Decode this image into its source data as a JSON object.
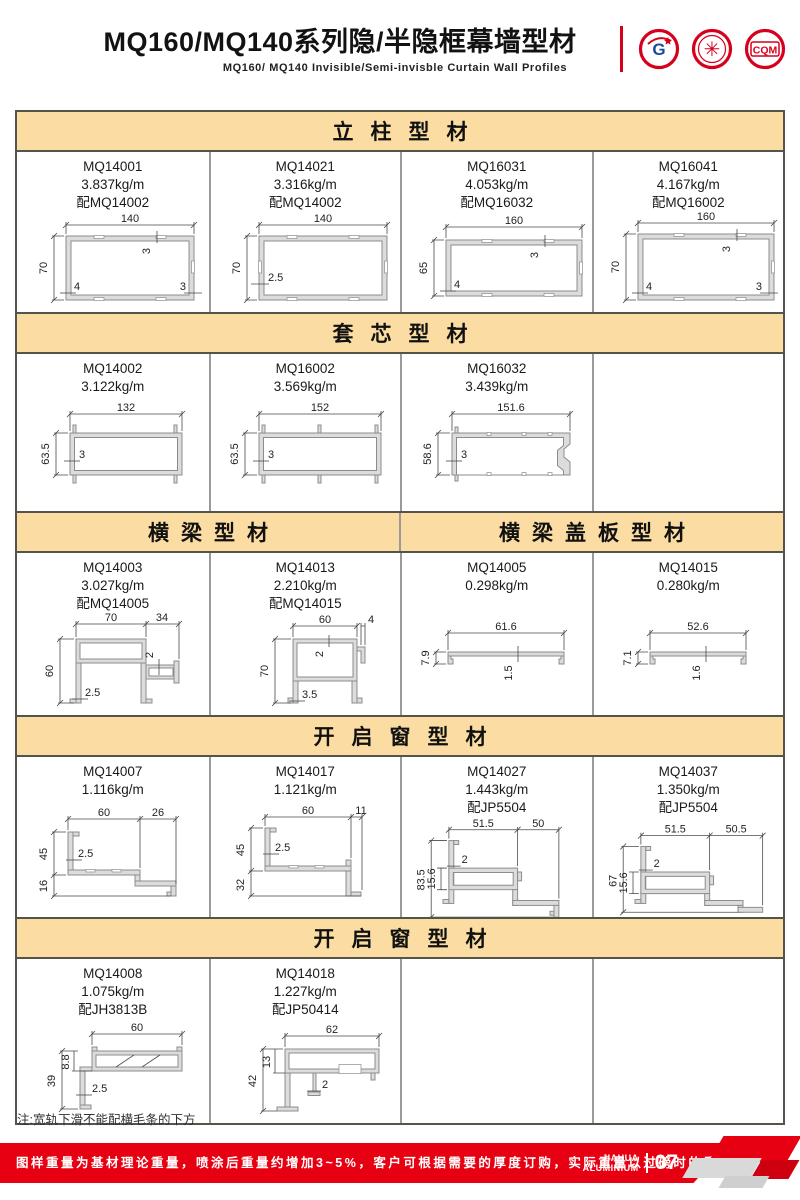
{
  "header": {
    "title": "MQ160/MQ140系列隐/半隐框幕墙型材",
    "subtitle": "MQ160/ MQ140  Invisible/Semi-invisble  Curtain  Wall  Profiles",
    "logo1_letter": "G",
    "logo2_glyph": "✳",
    "logo3_text": "CQM"
  },
  "sections": {
    "s1": "立柱型材",
    "s2": "套芯型材",
    "s3a": "横梁型材",
    "s3b": "横梁盖板型材",
    "s4": "开启窗型材",
    "s5": "开启窗型材"
  },
  "profiles": {
    "mq14001": {
      "code": "MQ14001",
      "weight": "3.837kg/m",
      "match": "配MQ14002",
      "d1": "140",
      "d2": "70",
      "d3": "3",
      "d4": "4",
      "d5": "3"
    },
    "mq14021": {
      "code": "MQ14021",
      "weight": "3.316kg/m",
      "match": "配MQ14002",
      "d1": "140",
      "d2": "70",
      "d3": "2.5"
    },
    "mq16031": {
      "code": "MQ16031",
      "weight": "4.053kg/m",
      "match": "配MQ16032",
      "d1": "160",
      "d2": "65",
      "d3": "3",
      "d4": "4"
    },
    "mq16041": {
      "code": "MQ16041",
      "weight": "4.167kg/m",
      "match": "配MQ16002",
      "d1": "160",
      "d2": "70",
      "d3": "3",
      "d4": "4",
      "d5": "3"
    },
    "mq14002": {
      "code": "MQ14002",
      "weight": "3.122kg/m",
      "d1": "132",
      "d2": "63.5",
      "d3": "3"
    },
    "mq16002": {
      "code": "MQ16002",
      "weight": "3.569kg/m",
      "d1": "152",
      "d2": "63.5",
      "d3": "3"
    },
    "mq16032": {
      "code": "MQ16032",
      "weight": "3.439kg/m",
      "d1": "151.6",
      "d2": "58.6",
      "d3": "3"
    },
    "mq14003": {
      "code": "MQ14003",
      "weight": "3.027kg/m",
      "match": "配MQ14005",
      "d1": "70",
      "d2": "34",
      "d3": "60",
      "d4": "2.5",
      "d5": "2"
    },
    "mq14013": {
      "code": "MQ14013",
      "weight": "2.210kg/m",
      "match": "配MQ14015",
      "d1": "60",
      "d2": "4",
      "d3": "70",
      "d4": "2",
      "d5": "3.5"
    },
    "mq14005": {
      "code": "MQ14005",
      "weight": "0.298kg/m",
      "d1": "61.6",
      "d2": "7.9",
      "d3": "1.5"
    },
    "mq14015": {
      "code": "MQ14015",
      "weight": "0.280kg/m",
      "d1": "52.6",
      "d2": "7.1",
      "d3": "1.6"
    },
    "mq14007": {
      "code": "MQ14007",
      "weight": "1.116kg/m",
      "d1": "60",
      "d2": "26",
      "d3": "45",
      "d4": "16",
      "d5": "2.5"
    },
    "mq14017": {
      "code": "MQ14017",
      "weight": "1.121kg/m",
      "d1": "60",
      "d2": "11",
      "d3": "45",
      "d4": "32",
      "d5": "2.5"
    },
    "mq14027": {
      "code": "MQ14027",
      "weight": "1.443kg/m",
      "match": "配JP5504",
      "d1": "51.5",
      "d2": "50",
      "d3": "83.5",
      "d4": "15.6",
      "d5": "2"
    },
    "mq14037": {
      "code": "MQ14037",
      "weight": "1.350kg/m",
      "match": "配JP5504",
      "d1": "51.5",
      "d2": "50.5",
      "d3": "67",
      "d4": "15.6",
      "d5": "2"
    },
    "mq14008": {
      "code": "MQ14008",
      "weight": "1.075kg/m",
      "match": "配JH3813B",
      "d1": "60",
      "d2": "39",
      "d3": "8.8",
      "d4": "2.5"
    },
    "mq14018": {
      "code": "MQ14018",
      "weight": "1.227kg/m",
      "match": "配JP50414",
      "d1": "62",
      "d2": "42",
      "d3": "13",
      "d4": "2"
    }
  },
  "note": "注:宽轨下滑不能配横毛条的下方",
  "footer": {
    "text": "图样重量为基材理论重量，喷涂后重量约增加3~5%，客户可根据需要的厚度订购，实际重量以过磅时的重量为准。",
    "brand_top": "JIAHUA",
    "brand_bottom": "ALUMINIUM",
    "page": "07"
  },
  "colors": {
    "accent_red": "#E60012",
    "band_orange": "#FBDCA2",
    "border_dark": "#55544A",
    "border_gray": "#999999",
    "drawing_gray": "#8C8C8C"
  }
}
